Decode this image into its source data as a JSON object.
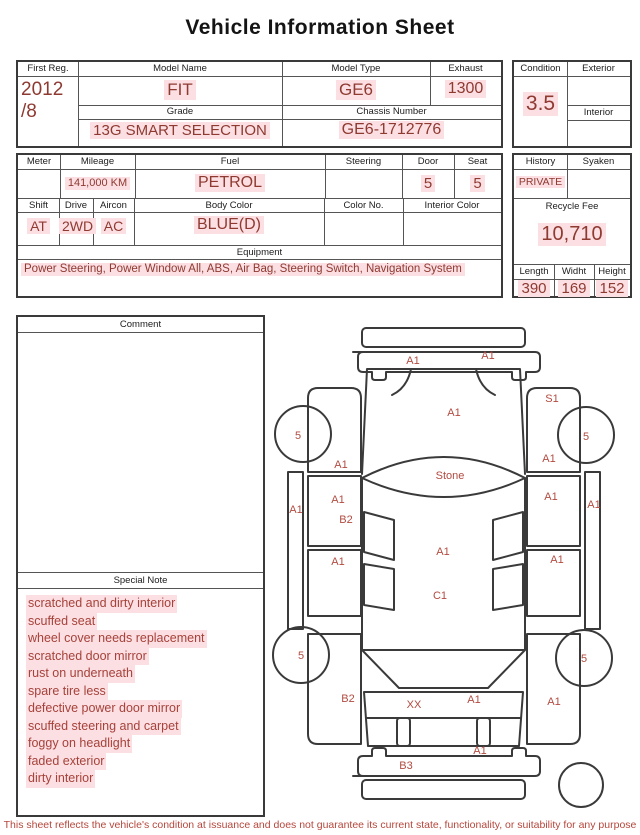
{
  "title": "Vehicle Information Sheet",
  "info1": {
    "first_reg": {
      "label": "First Reg.",
      "value": "2012\n/8"
    },
    "model_name": {
      "label": "Model Name",
      "value": "FIT"
    },
    "model_type": {
      "label": "Model Type",
      "value": "GE6"
    },
    "exhaust": {
      "label": "Exhaust",
      "value": "1300"
    },
    "grade": {
      "label": "Grade",
      "value": "13G SMART SELECTION"
    },
    "chassis_number": {
      "label": "Chassis Number",
      "value": "GE6-1712776"
    },
    "condition": {
      "label": "Condition",
      "value": "3.5"
    },
    "exterior": {
      "label": "Exterior",
      "value": ""
    },
    "interior": {
      "label": "Interior",
      "value": ""
    }
  },
  "info2": {
    "meter": {
      "label": "Meter",
      "value": ""
    },
    "mileage": {
      "label": "Mileage",
      "value": "141,000 KM"
    },
    "fuel": {
      "label": "Fuel",
      "value": "PETROL"
    },
    "steering": {
      "label": "Steering",
      "value": ""
    },
    "door": {
      "label": "Door",
      "value": "5"
    },
    "seat": {
      "label": "Seat",
      "value": "5"
    },
    "history": {
      "label": "History",
      "value": "PRIVATE"
    },
    "syaken": {
      "label": "Syaken",
      "value": ""
    },
    "shift": {
      "label": "Shift",
      "value": "AT"
    },
    "drive": {
      "label": "Drive",
      "value": "2WD"
    },
    "aircon": {
      "label": "Aircon",
      "value": "AC"
    },
    "body_color": {
      "label": "Body Color",
      "value": "BLUE(D)"
    },
    "color_no": {
      "label": "Color No.",
      "value": ""
    },
    "interior_color": {
      "label": "Interior Color",
      "value": ""
    },
    "equipment": {
      "label": "Equipment",
      "value": "Power Steering, Power Window  All, ABS, Air Bag, Steering Switch, Navigation System"
    },
    "recycle_fee": {
      "label": "Recycle Fee",
      "value": "10,710"
    },
    "length": {
      "label": "Length",
      "value": "390"
    },
    "width": {
      "label": "Widht",
      "value": "169"
    },
    "height": {
      "label": "Height",
      "value": "152"
    }
  },
  "comment": {
    "label": "Comment",
    "value": ""
  },
  "special_note": {
    "label": "Special Note",
    "items": [
      "scratched and dirty interior",
      "scuffed seat",
      "wheel cover needs replacement",
      "scratched door mirror",
      "rust on underneath",
      "spare tire less",
      "defective power door mirror",
      "scuffed steering and carpet",
      "foggy on headlight",
      "faded exterior",
      "dirty interior"
    ]
  },
  "diagram": {
    "labels": [
      {
        "text": "A1",
        "x": 145,
        "y": 52
      },
      {
        "text": "A1",
        "x": 220,
        "y": 47
      },
      {
        "text": "A1",
        "x": 186,
        "y": 104
      },
      {
        "text": "S1",
        "x": 284,
        "y": 90
      },
      {
        "text": "5",
        "x": 30,
        "y": 127
      },
      {
        "text": "5",
        "x": 318,
        "y": 128
      },
      {
        "text": "A1",
        "x": 73,
        "y": 156
      },
      {
        "text": "A1",
        "x": 281,
        "y": 150
      },
      {
        "text": "Stone",
        "x": 182,
        "y": 167
      },
      {
        "text": "A1",
        "x": 28,
        "y": 201
      },
      {
        "text": "A1",
        "x": 70,
        "y": 191
      },
      {
        "text": "B2",
        "x": 78,
        "y": 211
      },
      {
        "text": "A1",
        "x": 283,
        "y": 188
      },
      {
        "text": "A1",
        "x": 326,
        "y": 196
      },
      {
        "text": "A1",
        "x": 175,
        "y": 243
      },
      {
        "text": "A1",
        "x": 70,
        "y": 253
      },
      {
        "text": "A1",
        "x": 289,
        "y": 251
      },
      {
        "text": "C1",
        "x": 172,
        "y": 287
      },
      {
        "text": "5",
        "x": 33,
        "y": 347
      },
      {
        "text": "5",
        "x": 316,
        "y": 350
      },
      {
        "text": "B2",
        "x": 80,
        "y": 390
      },
      {
        "text": "XX",
        "x": 146,
        "y": 396
      },
      {
        "text": "A1",
        "x": 206,
        "y": 391
      },
      {
        "text": "A1",
        "x": 286,
        "y": 393
      },
      {
        "text": "A1",
        "x": 212,
        "y": 442
      },
      {
        "text": "B3",
        "x": 138,
        "y": 457
      }
    ]
  },
  "footer": "This sheet reflects the vehicle's condition at issuance and does not guarantee its current state, functionality, or suitability for any purpose",
  "colors": {
    "value_red": "#8e3a31",
    "note_red": "#a6423a",
    "diagram_red": "#b24b40",
    "highlight_pink": "#fcdfe3",
    "border": "#3a3a3a"
  }
}
